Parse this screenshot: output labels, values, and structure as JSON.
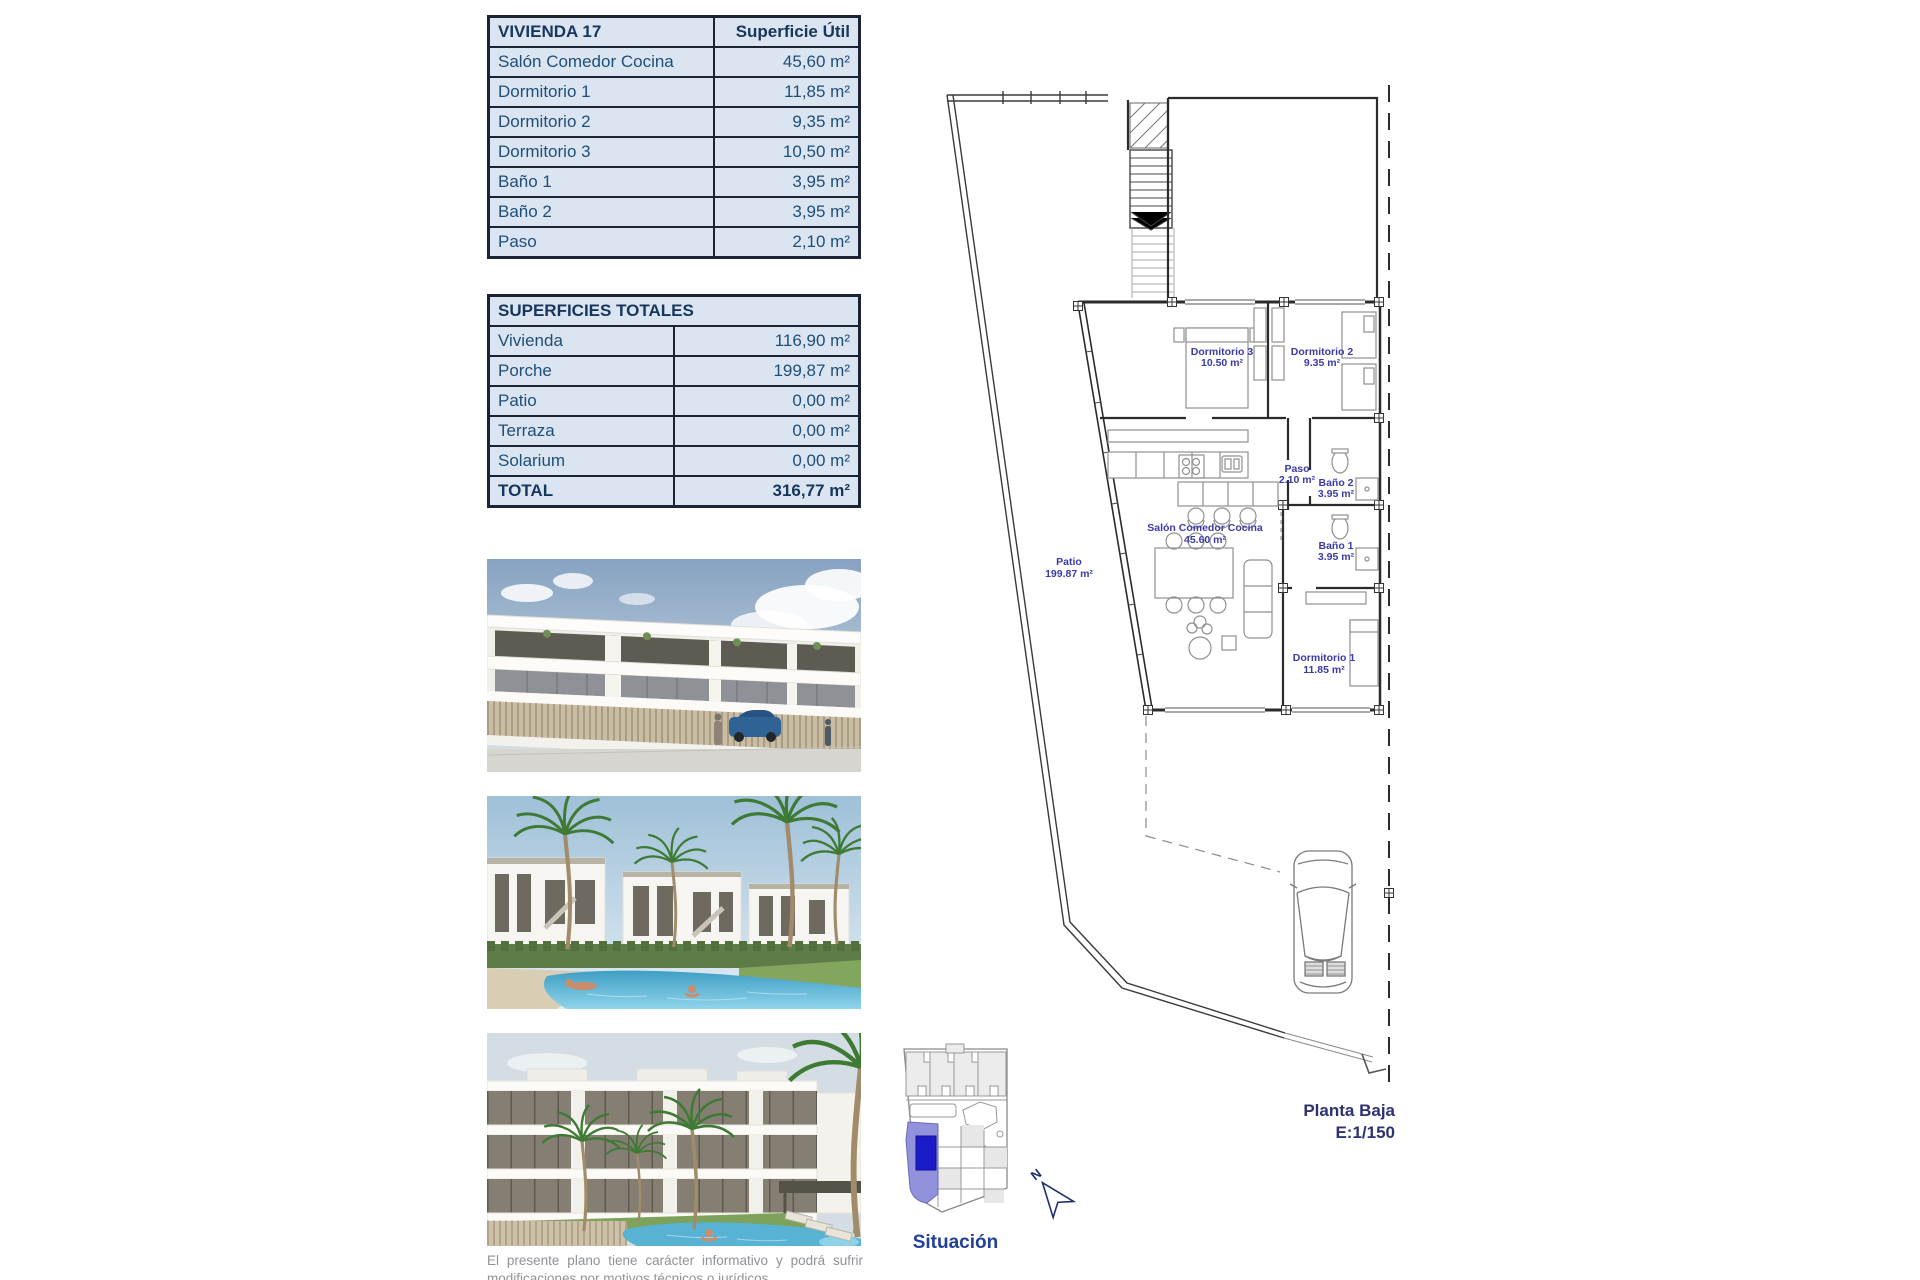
{
  "colors": {
    "table_background": "#dbe5f1",
    "table_border": "#1c2335",
    "table_text": "#1f4e79",
    "plan_room_label": "#3a3aa8",
    "plan_caption": "#2e3173",
    "situacion_caption": "#21409a",
    "highlight_plot_light": "#9191dc",
    "highlight_plot_dark": "#1b1bc8",
    "disclaimer_text": "#8f9296"
  },
  "vivienda_table": {
    "title": "VIVIENDA 17",
    "header_value": "Superficie Útil",
    "rows": [
      {
        "label": "Salón Comedor Cocina",
        "value": "45,60 m²"
      },
      {
        "label": "Dormitorio 1",
        "value": "11,85 m²"
      },
      {
        "label": "Dormitorio 2",
        "value": "9,35 m²"
      },
      {
        "label": "Dormitorio 3",
        "value": "10,50 m²"
      },
      {
        "label": "Baño 1",
        "value": "3,95 m²"
      },
      {
        "label": "Baño 2",
        "value": "3,95 m²"
      },
      {
        "label": "Paso",
        "value": "2,10 m²"
      }
    ]
  },
  "totales_table": {
    "title": "SUPERFICIES TOTALES",
    "rows": [
      {
        "label": "Vivienda",
        "value": "116,90 m²"
      },
      {
        "label": "Porche",
        "value": "199,87 m²"
      },
      {
        "label": "Patio",
        "value": "0,00 m²"
      },
      {
        "label": "Terraza",
        "value": "0,00 m²"
      },
      {
        "label": "Solarium",
        "value": "0,00 m²"
      }
    ],
    "total_row": {
      "label": "TOTAL",
      "value": "316,77 m²"
    }
  },
  "floor_plan": {
    "labels": {
      "dormitorio3": {
        "name": "Dormitorio 3",
        "area": "10.50 m²"
      },
      "dormitorio2": {
        "name": "Dormitorio 2",
        "area": "9.35 m²"
      },
      "paso": {
        "name": "Paso",
        "area": "2.10 m²"
      },
      "bano2": {
        "name": "Baño 2",
        "area": "3.95 m²"
      },
      "bano1": {
        "name": "Baño 1",
        "area": "3.95 m²"
      },
      "salon": {
        "name": "Salón Comedor Cocina",
        "area": "45.60 m²"
      },
      "patio": {
        "name": "Patio",
        "area": "199.87 m²"
      },
      "dormitorio1": {
        "name": "Dormitorio 1",
        "area": "11.85 m²"
      }
    },
    "caption": {
      "line1": "Planta Baja",
      "line2": "E:1/150"
    },
    "north": "N"
  },
  "situation_map": {
    "caption": "Situación"
  },
  "disclaimer": "El presente plano tiene carácter informativo y podrá sufrir modificaciones por motivos técnicos o jurídicos."
}
